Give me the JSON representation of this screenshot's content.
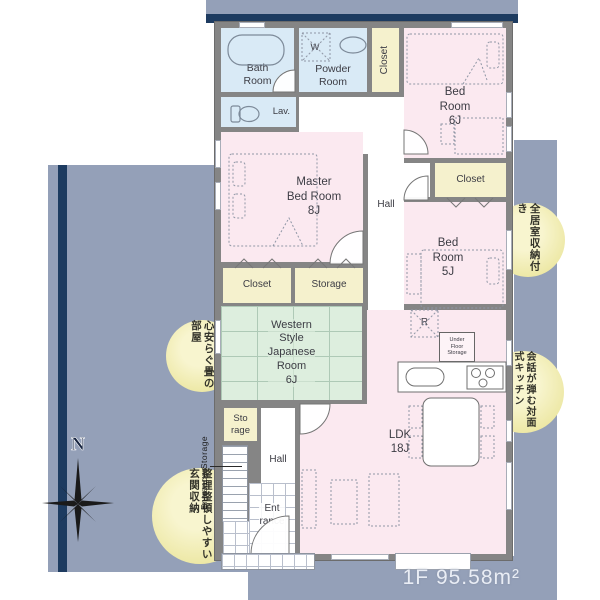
{
  "floor_area": "1F 95.58m²",
  "compass": {
    "label": "N"
  },
  "side_note": {
    "label": "Entrance Storage"
  },
  "rooms": {
    "bath": {
      "label": "Bath\nRoom"
    },
    "powder": {
      "label": "Powder\nRoom"
    },
    "washer": {
      "label": "W"
    },
    "closet_top": {
      "label": "Closet"
    },
    "bed6": {
      "label": "Bed\nRoom\n6J"
    },
    "lav": {
      "label": "Lav."
    },
    "master": {
      "label": "Master\nBed Room\n8J"
    },
    "hall_upper": {
      "label": "Hall"
    },
    "closet_5j": {
      "label": "Closet"
    },
    "bed5": {
      "label": "Bed\nRoom\n5J"
    },
    "closet_master": {
      "label": "Closet"
    },
    "storage_master": {
      "label": "Storage"
    },
    "jroom": {
      "label": "Western\nStyle\nJapanese\nRoom\n6J"
    },
    "storage_small": {
      "label": "Sto\nrage"
    },
    "hall_lower": {
      "label": "Hall"
    },
    "entrance": {
      "label": "Ent\nrance"
    },
    "ldk": {
      "label": "LDK\n18J"
    },
    "fridge": {
      "label": "R"
    },
    "under_floor_storage": {
      "label": "Under\nFloor\nStorage"
    }
  },
  "badges": [
    {
      "lines": [
        "全居室",
        "収納付き"
      ]
    },
    {
      "lines": [
        "会話が弾む",
        "対面式キッチン"
      ]
    },
    {
      "lines": [
        "心安らぐ",
        "畳の部屋"
      ]
    },
    {
      "lines": [
        "整理整頓しやすい",
        "玄関収納"
      ]
    }
  ],
  "colors": {
    "slate": "#94a0b8",
    "navy": "#1d3b60",
    "wall": "#858585",
    "pink": "#fbe9f0",
    "blue": "#d9eaf6",
    "yellow": "#f5f1cd",
    "green": "#ddeede",
    "badge1": "#f8f5cf",
    "badge2": "#e8e292",
    "ink": "#3c3c44"
  }
}
